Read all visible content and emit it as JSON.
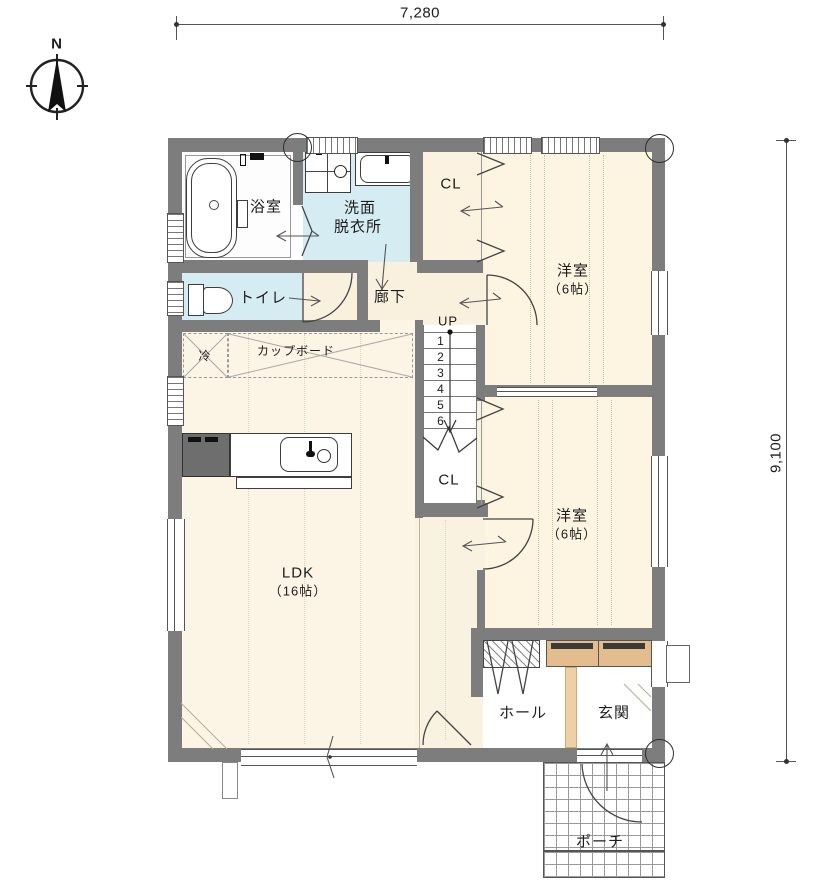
{
  "compass": {
    "north_label": "N"
  },
  "dimensions": {
    "width_label": "7,280",
    "height_label": "9,100"
  },
  "rooms": {
    "bathroom": "浴室",
    "washroom_line1": "洗面",
    "washroom_line2": "脱衣所",
    "toilet": "トイレ",
    "hallway": "廊下",
    "closet_top": "CL",
    "closet_mid": "CL",
    "bedroom1_line1": "洋室",
    "bedroom1_line2": "（6帖）",
    "bedroom2_line1": "洋室",
    "bedroom2_line2": "（6帖）",
    "ldk_line1": "LDK",
    "ldk_line2": "（16帖）",
    "hall": "ホール",
    "entrance": "玄関",
    "porch": "ポーチ",
    "fridge": "冷",
    "cupboard": "カップボード"
  },
  "stairs": {
    "up_label": "UP",
    "steps": [
      "1",
      "2",
      "3",
      "4",
      "5",
      "6"
    ]
  },
  "palette": {
    "wall_gray": "#7d7d7d",
    "water_blue": "#d6ecf3",
    "floor_cream": "#fcf4e3",
    "wood_tan": "#e3bd8e",
    "step_tan": "#ecd0a6"
  }
}
